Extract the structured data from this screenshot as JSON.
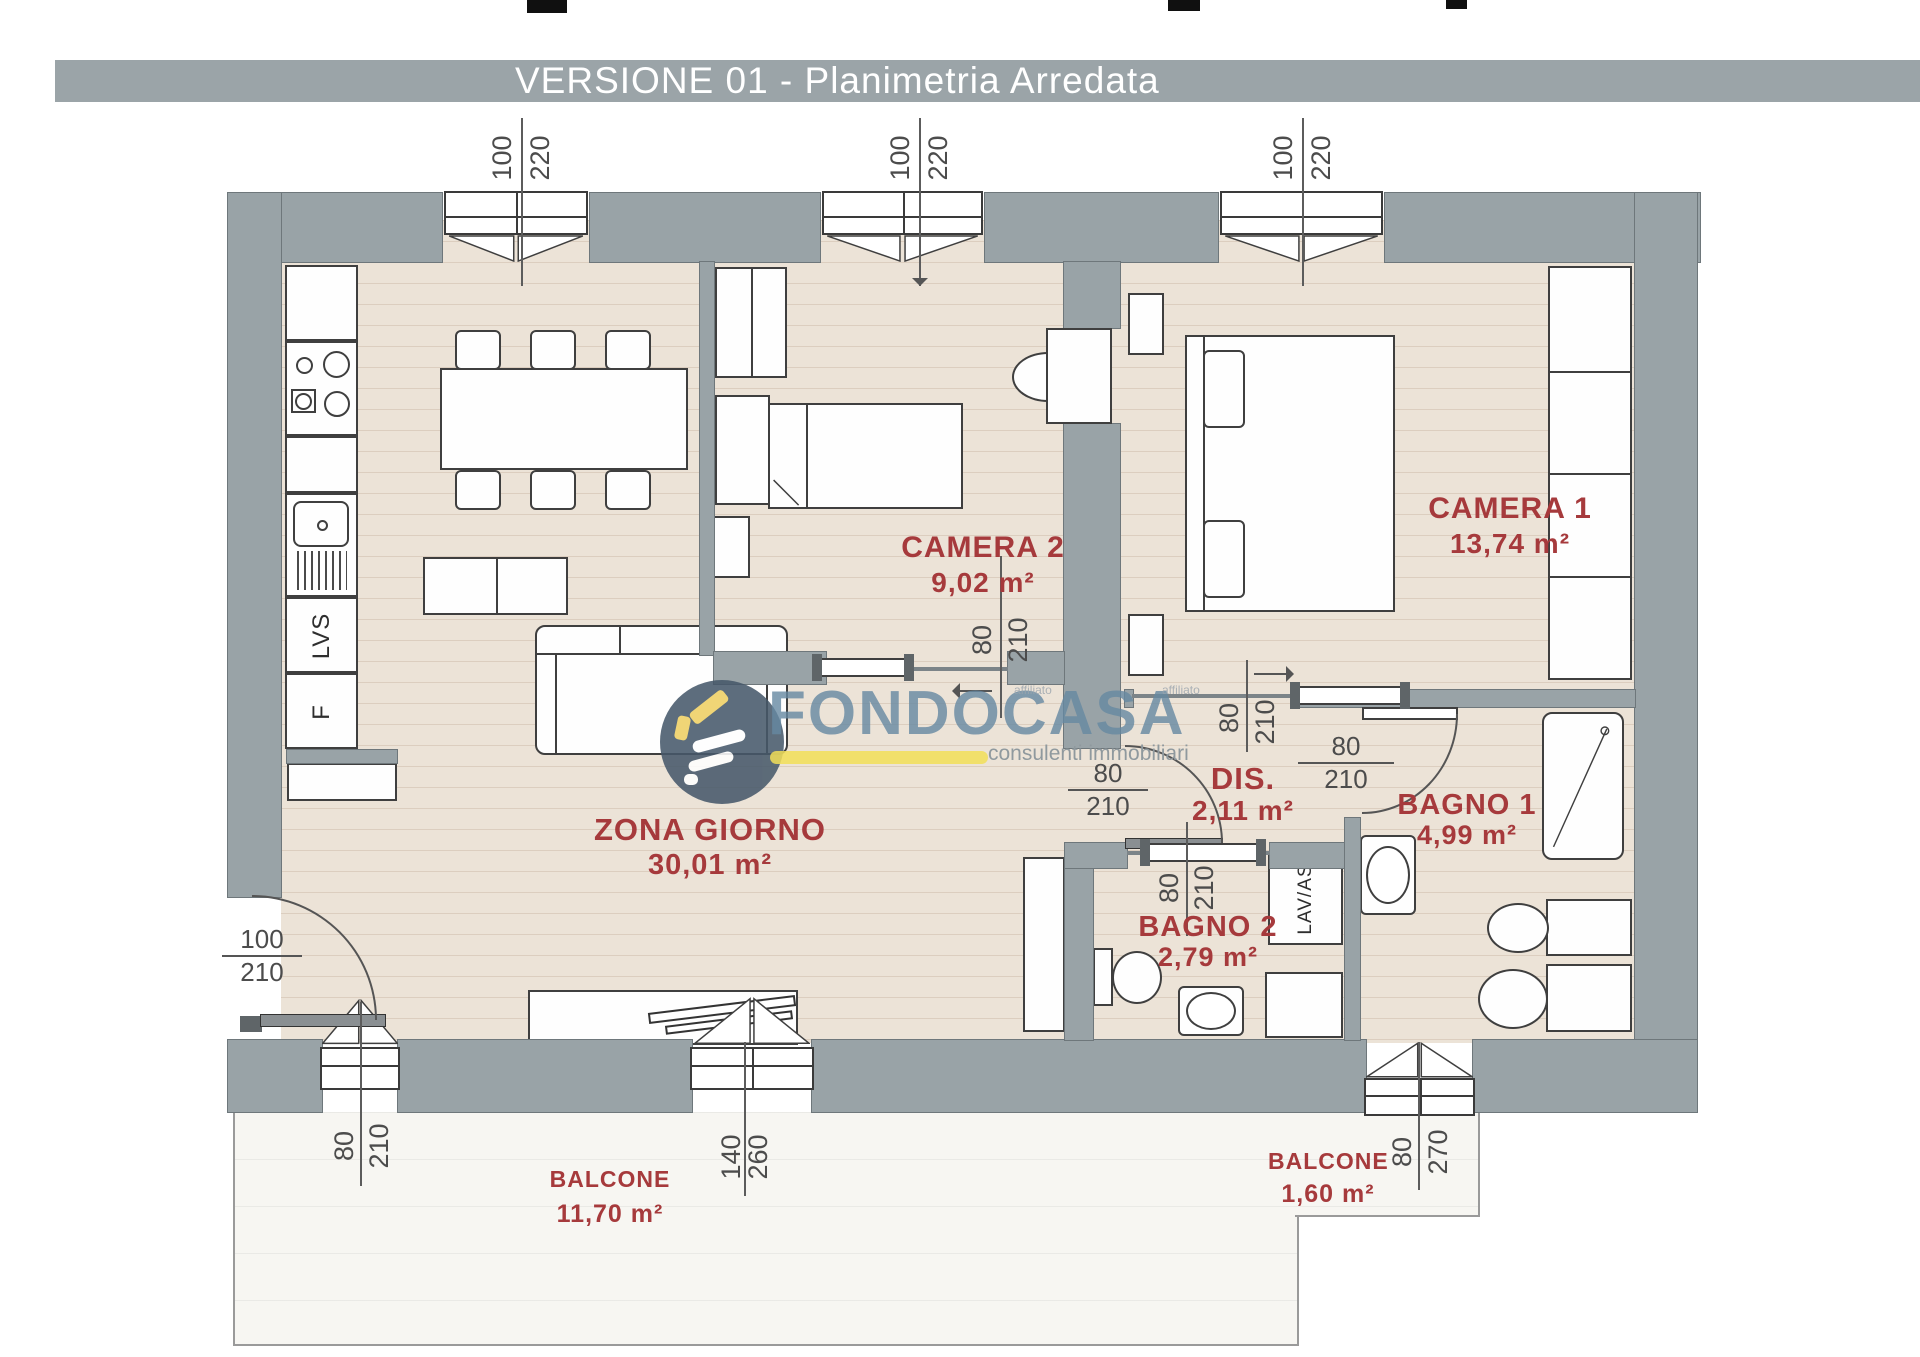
{
  "title": "VERSIONE 01 - Planimetria Arredata",
  "brand": {
    "name": "FONDOCASA",
    "tagline": "consulenti immobiliari",
    "affiliate_note": "affiliato"
  },
  "rooms": {
    "zona_giorno": {
      "name": "ZONA GIORNO",
      "area": "30,01 m²"
    },
    "camera1": {
      "name": "CAMERA 1",
      "area": "13,74 m²"
    },
    "camera2": {
      "name": "CAMERA 2",
      "area": "9,02 m²"
    },
    "dis": {
      "name": "DIS.",
      "area": "2,11 m²"
    },
    "bagno1": {
      "name": "BAGNO 1",
      "area": "4,99 m²"
    },
    "bagno2": {
      "name": "BAGNO 2",
      "area": "2,79 m²"
    },
    "balcone1": {
      "name": "BALCONE",
      "area": "11,70 m²"
    },
    "balcone2": {
      "name": "BALCONE",
      "area": "1,60 m²"
    }
  },
  "fixtures": {
    "dishwasher": "LVS",
    "fridge": "F",
    "laundry_column": "LAV/AS"
  },
  "dimensions": {
    "window1": {
      "w": "100",
      "h": "220"
    },
    "window2": {
      "w": "100",
      "h": "220"
    },
    "window3": {
      "w": "100",
      "h": "220"
    },
    "camera2_door": {
      "w": "80",
      "h": "210"
    },
    "camera1_door": {
      "w": "80",
      "h": "210"
    },
    "dis_door": {
      "w": "80",
      "h": "210"
    },
    "bagno1_door": {
      "w": "80",
      "h": "210"
    },
    "bagno2_door": {
      "w": "80",
      "h": "210"
    },
    "entrance_door": {
      "w": "100",
      "h": "210"
    },
    "balcony_door": {
      "w": "80",
      "h": "210"
    },
    "balcony_double_door": {
      "w": "140",
      "h": "260"
    },
    "bagno1_window": {
      "w": "80",
      "h": "270"
    }
  },
  "colors": {
    "wall": "#99a3a7",
    "floor": "#ece3d7",
    "balcony": "#f7f6f2",
    "room_label": "#a63a3c",
    "dimension_text": "#4c4c4c",
    "title_band": "#9ba4a8",
    "brand_blue": "#6689a2",
    "brand_navy": "#46586a",
    "brand_yellow": "#f2df58"
  }
}
